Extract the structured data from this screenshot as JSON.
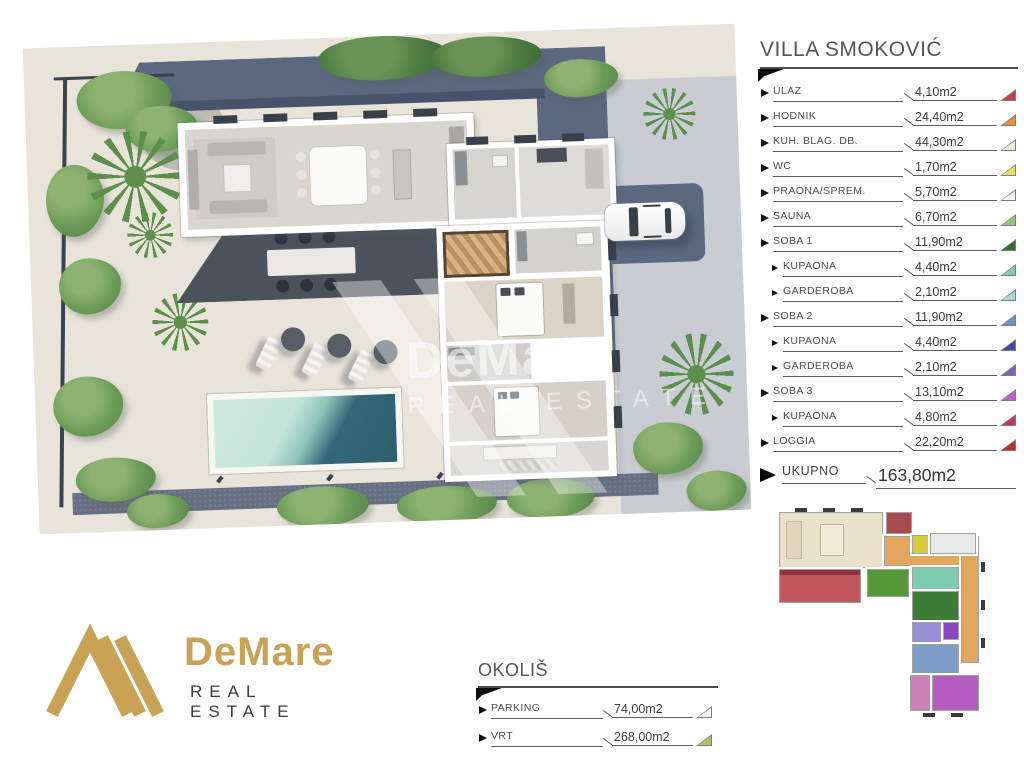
{
  "plan_legend": {
    "title": "VILLA SMOKOVIĆ",
    "items": [
      {
        "label": "ULAZ",
        "value": "4,10m2",
        "color": "#bf4743",
        "indent": false
      },
      {
        "label": "HODNIK",
        "value": "24,40m2",
        "color": "#dd9143",
        "indent": false
      },
      {
        "label": "KUH. BLAG. DB.",
        "value": "44,30m2",
        "color": "#f1ecd9",
        "indent": false
      },
      {
        "label": "WC",
        "value": "1,70m2",
        "color": "#eae35f",
        "indent": false
      },
      {
        "label": "PRAONA/SPREM.",
        "value": "5,70m2",
        "color": "#f7f7f5",
        "indent": false
      },
      {
        "label": "SAUNA",
        "value": "6,70m2",
        "color": "#8cc878",
        "indent": false
      },
      {
        "label": "SOBA 1",
        "value": "11,90m2",
        "color": "#2f7032",
        "indent": false
      },
      {
        "label": "KUPAONA",
        "value": "4,40m2",
        "color": "#7ecfad",
        "indent": true
      },
      {
        "label": "GARDEROBA",
        "value": "2,10m2",
        "color": "#a2dbd1",
        "indent": true
      },
      {
        "label": "SOBA 2",
        "value": "11,90m2",
        "color": "#7191c4",
        "indent": false
      },
      {
        "label": "KUPAONA",
        "value": "4,40m2",
        "color": "#4549a5",
        "indent": true
      },
      {
        "label": "GARDEROBA",
        "value": "2,10m2",
        "color": "#7d62b5",
        "indent": true
      },
      {
        "label": "SOBA 3",
        "value": "13,10m2",
        "color": "#bc64c5",
        "indent": false
      },
      {
        "label": "KUPAONA",
        "value": "4,80m2",
        "color": "#bf3a63",
        "indent": true
      },
      {
        "label": "LOGGIA",
        "value": "22,20m2",
        "color": "#bf2f2c",
        "indent": false
      }
    ],
    "total": {
      "label": "UKUPNO",
      "value": "163,80m2"
    }
  },
  "surroundings": {
    "title": "OKOLIŠ",
    "items": [
      {
        "label": "PARKING",
        "value": "74,00m2",
        "color": "#f5f5f3"
      },
      {
        "label": "VRT",
        "value": "268,00m2",
        "color": "#b9bc6e"
      }
    ]
  },
  "brand": {
    "name": "DeMare",
    "tagline": "REAL ESTATE",
    "accent": "#c9a254"
  },
  "watermark": {
    "name": "DeMare",
    "tagline": "REAL ESTATE"
  },
  "site": {
    "colors": {
      "ground": "#e9e4da",
      "driveway": "#5b6880",
      "driveway_dark": "#47536b",
      "cobble": "#c9ccd2",
      "terrace": "#4c525c",
      "floor": "#d9d6d1",
      "pool_light": "#c9e7dd",
      "pool_dark": "#2d5f6e"
    }
  },
  "miniplan": {
    "colors": {
      "kuhinja": "#e9e2cb",
      "ulaz": "#a84a50",
      "hodnik": "#e2a65e",
      "wc": "#d6ca3e",
      "praona": "#e9ebe7",
      "sauna": "#55983a",
      "loggia": "#c1565c",
      "kupaona1": "#7ecbb1",
      "soba1": "#3d7c38",
      "kupaona2": "#998fd6",
      "garderoba2": "#8a44bd",
      "soba2": "#7e9dc9",
      "kupaona3": "#cf80b6",
      "soba3": "#b55cc3"
    }
  }
}
